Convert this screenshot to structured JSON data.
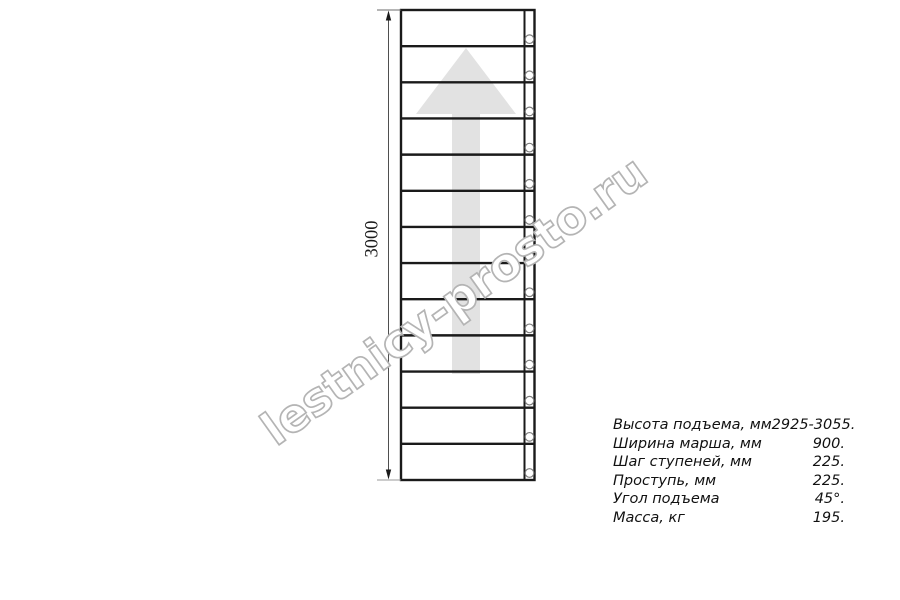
{
  "drawing": {
    "dimension_label": "3000",
    "step_rows": 13
  },
  "watermark": {
    "text": "lestnicy-prosto.ru"
  },
  "specs": {
    "rows": [
      {
        "label": "Высота подъема, мм",
        "value": "2925-3055."
      },
      {
        "label": "Ширина марша, мм",
        "value": "900."
      },
      {
        "label": "Шаг ступеней, мм",
        "value": "225."
      },
      {
        "label": "Проступь, мм",
        "value": "225."
      },
      {
        "label": "Угол подъема",
        "value": "45°."
      },
      {
        "label": "Масса, кг",
        "value": "195."
      }
    ]
  },
  "colors": {
    "line": "#1a1a1a",
    "arrow_fill": "#e2e2e2",
    "circle_stroke": "#7c7c7c",
    "watermark_outline": "#b4b4b4",
    "dimension_line": "#4f4f4f"
  }
}
